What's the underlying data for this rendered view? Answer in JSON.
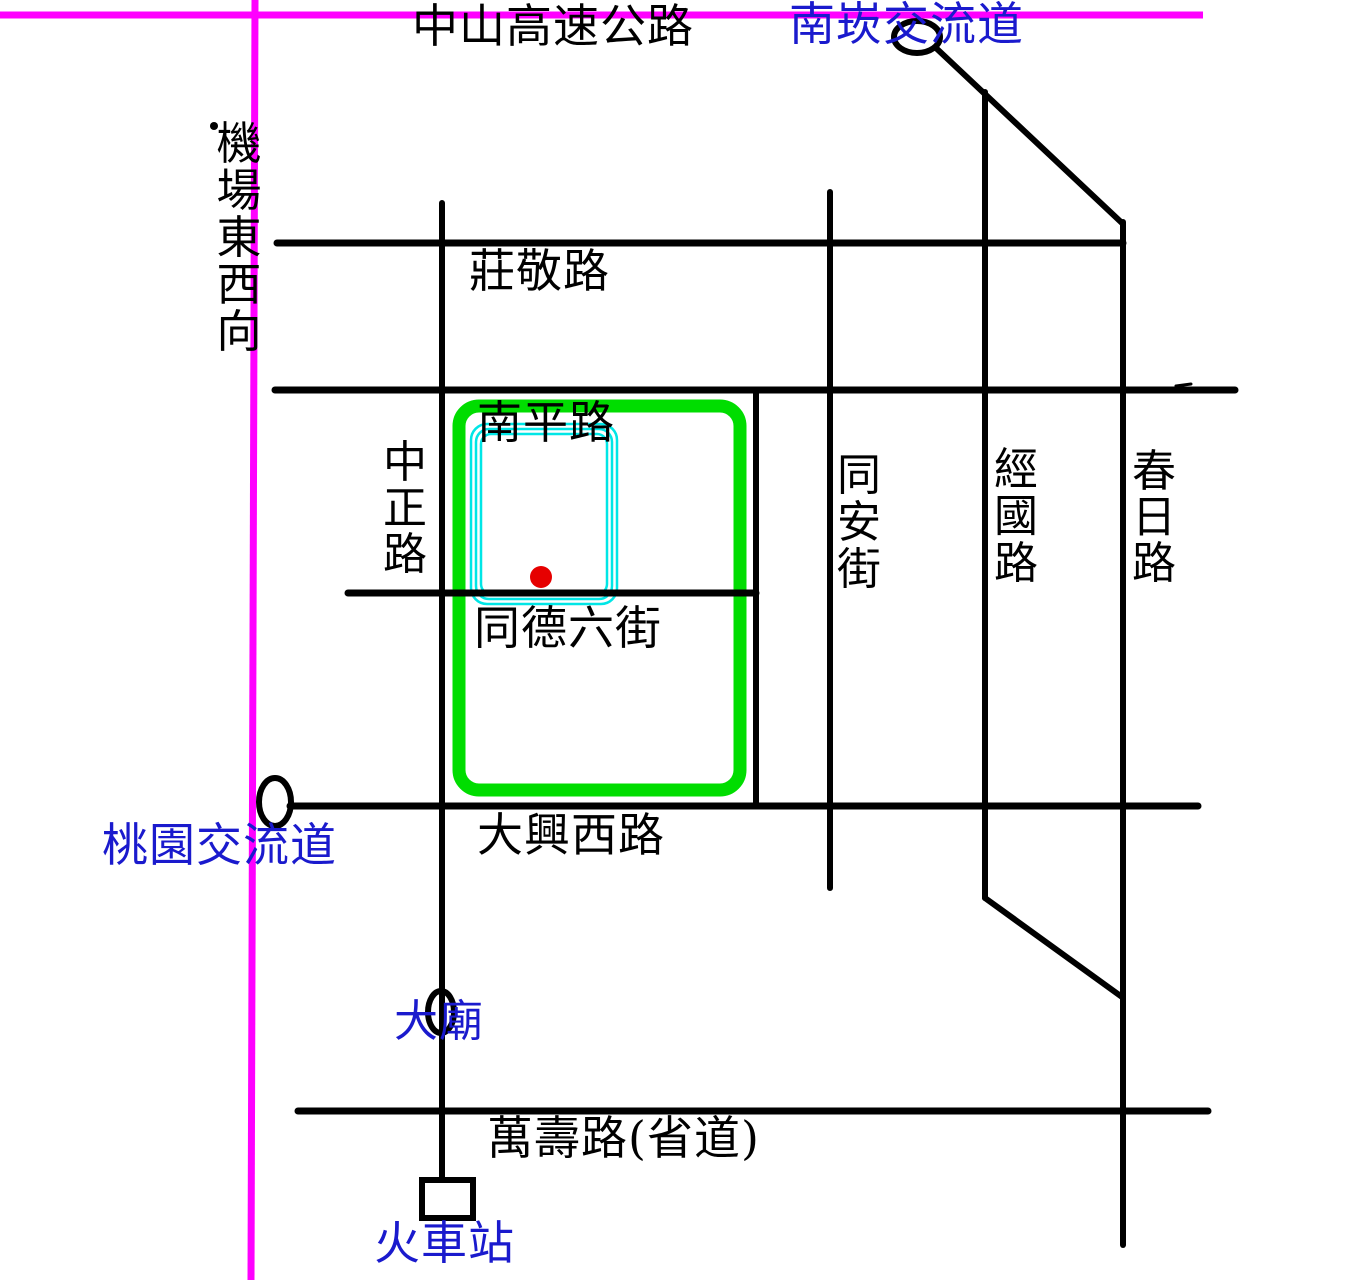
{
  "map": {
    "roads": {
      "zhongshan_freeway": "中山高速公路",
      "airport_east_west": "機場東西向",
      "zhuangjing_rd": "莊敬路",
      "nanping_rd": "南平路",
      "zhongzheng_rd": "中正路",
      "tongde_6th_st": "同德六街",
      "tongan_st": "同安街",
      "jingguo_rd": "經國路",
      "chunri_rd": "春日路",
      "daxing_west_rd": "大興西路",
      "wanshou_rd": "萬壽路(省道)"
    },
    "landmarks": {
      "nankan_interchange": "南崁交流道",
      "taoyuan_interchange": "桃園交流道",
      "temple": "大廟",
      "train_station": "火車站"
    },
    "colors": {
      "highway_magenta": "#ff00ff",
      "road_black": "#000000",
      "label_blue": "#1a1acd",
      "highlight_green": "#00dd00",
      "highlight_cyan": "#00e6e6",
      "marker_red": "#e60000"
    }
  }
}
